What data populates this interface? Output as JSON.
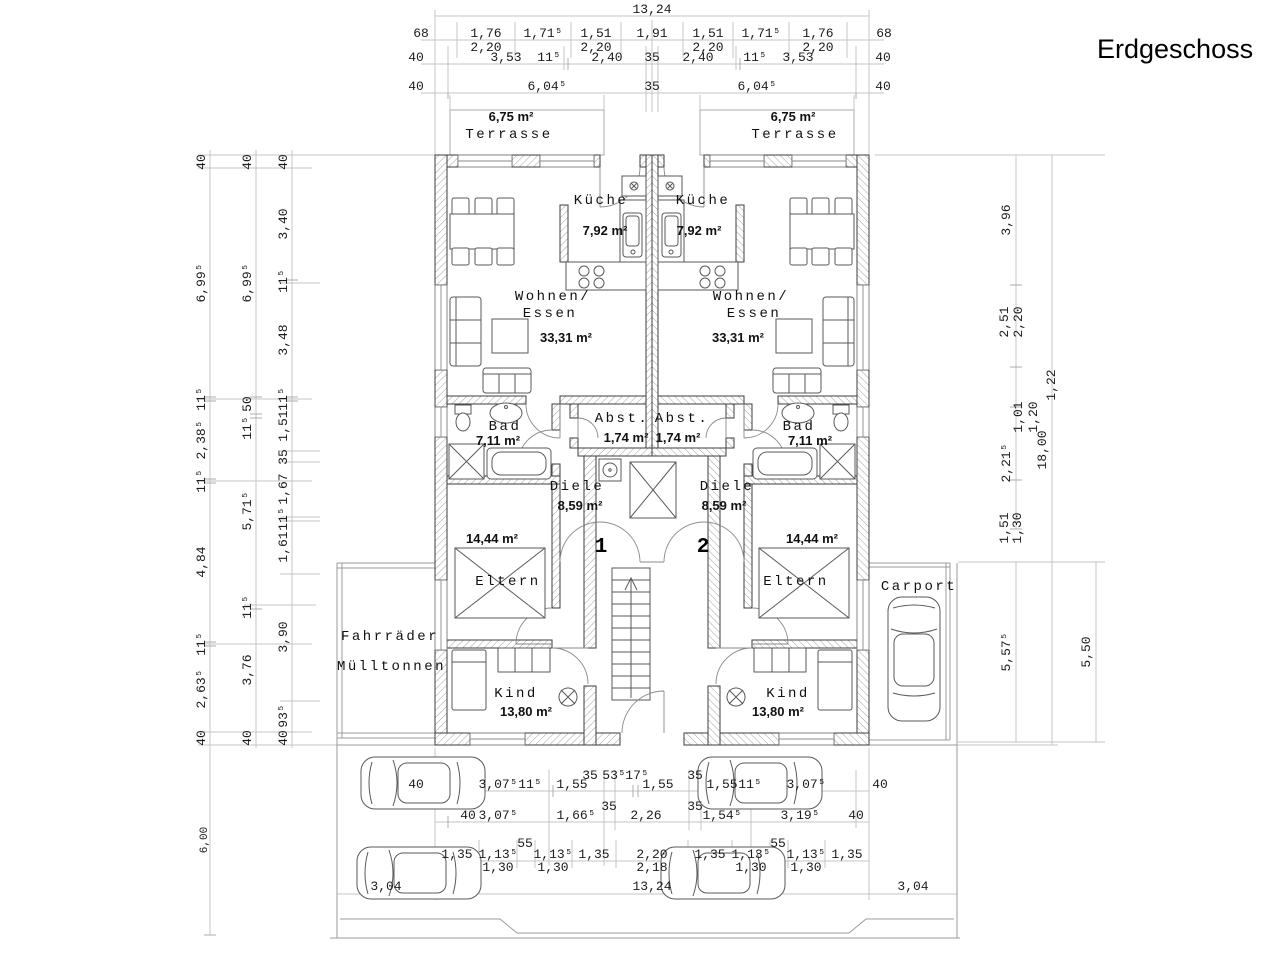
{
  "title": "Erdgeschoss",
  "rooms": {
    "terrasse_label": "Terrasse",
    "terrasse_area": "6,75 m²",
    "kueche_label": "Küche",
    "kueche_area": "7,92 m²",
    "wohnen_line1": "Wohnen/",
    "wohnen_line2": "Essen",
    "wohnen_area": "33,31 m²",
    "bad_label": "Bad",
    "bad_area": "7,11 m²",
    "abst_label": "Abst.",
    "abst_area": "1,74 m²",
    "diele_label": "Diele",
    "diele_area": "8,59 m²",
    "eltern_label": "Eltern",
    "eltern_area": "14,44 m²",
    "kind_label": "Kind",
    "kind_area": "13,80 m²",
    "fahrraeder_label": "Fahrräder",
    "muelltonnen_label": "Mülltonnen",
    "carport_label": "Carport",
    "unit1": "1",
    "unit2": "2"
  },
  "dims": {
    "top": {
      "total": "13,24",
      "row2": [
        "68",
        "1,76",
        "1,71⁵",
        "1,51",
        "1,91",
        "1,51",
        "1,71⁵",
        "1,76",
        "68"
      ],
      "row2_sub": [
        "2,20",
        "2,20",
        "2,20",
        "2,20"
      ],
      "row3": [
        "40",
        "3,53",
        "11⁵",
        "2,40",
        "35",
        "2,40",
        "11⁵",
        "3,53",
        "40"
      ],
      "row4": [
        "40",
        "6,04⁵",
        "35",
        "6,04⁵",
        "40"
      ]
    },
    "left": {
      "col1": [
        "40",
        "6,99⁵",
        "11⁵",
        "2,38⁵",
        "11⁵",
        "4,84",
        "11⁵",
        "2,63⁵",
        "40"
      ],
      "col1_bottom": "6,00",
      "col2": [
        "40",
        "6,99⁵",
        "50",
        "11⁵",
        "5,71⁵",
        "11⁵",
        "3,76",
        "40"
      ],
      "col3": [
        "40",
        "3,40",
        "11⁵",
        "3,48",
        "11⁵",
        "1,51",
        "35",
        "1,67",
        "11⁵",
        "1,61",
        "3,90",
        "93⁵",
        "40"
      ]
    },
    "right": {
      "col1": [
        "3,96",
        "2,51",
        "1,22",
        "2,21⁵",
        "1,51"
      ],
      "col1_sub": [
        "2,20",
        "1,01",
        "1,20",
        "1,30"
      ],
      "col1_bottom": "5,57⁵",
      "col2_total": "18,00",
      "col3_bottom": "5,50"
    },
    "bottom": {
      "row1": [
        "40",
        "3,07⁵",
        "11⁵",
        "1,55",
        "35",
        "53⁵",
        "17⁵",
        "1,55",
        "35",
        "1,55",
        "11⁵",
        "3,07⁵",
        "40"
      ],
      "row2": [
        "40",
        "3,07⁵",
        "1,66⁵",
        "35",
        "2,26",
        "35",
        "1,54⁵",
        "3,19⁵",
        "40"
      ],
      "row3": [
        "1,35",
        "1,13⁵",
        "55",
        "1,13⁵",
        "1,35",
        "2,20",
        "1,35",
        "1,13⁵",
        "55",
        "1,13⁵",
        "1,35"
      ],
      "row3_sub": [
        "1,30",
        "1,30",
        "2,18",
        "1,30",
        "1,30"
      ],
      "row4": [
        "3,04",
        "13,24",
        "3,04"
      ]
    }
  }
}
